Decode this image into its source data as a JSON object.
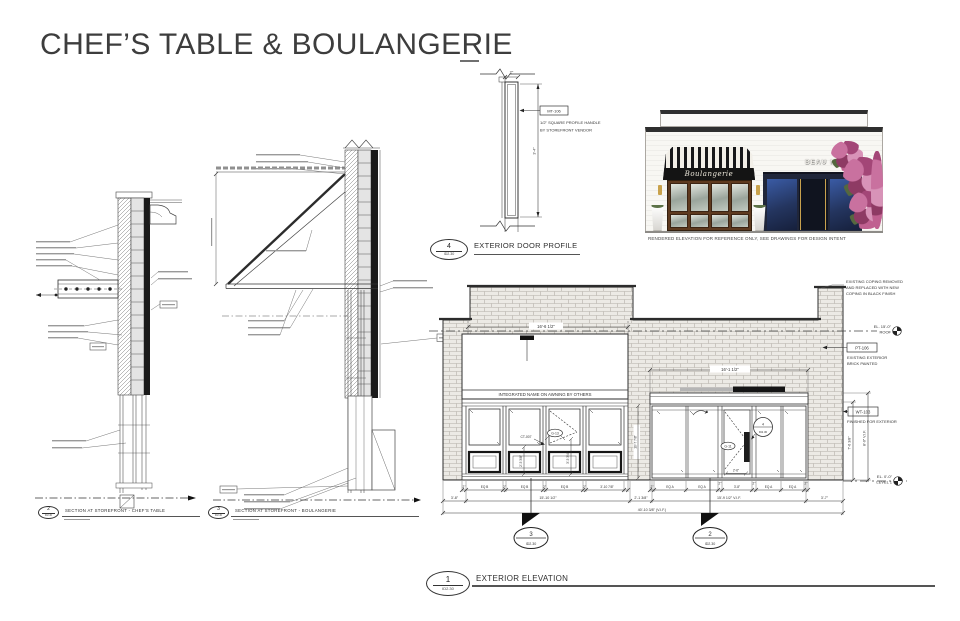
{
  "page": {
    "title": "CHEF’S TABLE & BOULANGERIE"
  },
  "render": {
    "awning_sign": "Boulangerie",
    "storefront_sign": "BEAU MONDE",
    "caption": "RENDERED ELEVATION FOR REFERENCE ONLY, SEE DRAWINGS FOR DESIGN INTENT"
  },
  "door_profile": {
    "bubble_num": "4",
    "bubble_sheet": "ID2.30",
    "title": "EXTERIOR DOOR PROFILE",
    "tag": "MT-106",
    "note1": "1/2\" SQUARE PROFILE HANDLE",
    "note2": "BY STOREFRONT VENDOR",
    "dim_width": "2\"",
    "dim_height": "3'-4\""
  },
  "section_chefs": {
    "bubble_num": "2",
    "bubble_sheet": "ID2.30",
    "title": "SECTION AT STOREFRONT - CHEF'S TABLE"
  },
  "section_boulangerie": {
    "bubble_num": "3",
    "bubble_sheet": "ID2.30",
    "title": "SECTION AT STOREFRONT - BOULANGERIE"
  },
  "elevation": {
    "bubble_num": "1",
    "bubble_sheet": "ID2.30",
    "title": "EXTERIOR ELEVATION",
    "awning_note": "INTEGRATED NAME ON AWNING BY OTHERS",
    "coping_note_1": "EXISTING COPING REMOVED",
    "coping_note_2": "AND REPLACED WITH NEW",
    "coping_note_3": "COPING IN BLACK FINISH",
    "pt_tag": "PT-106",
    "pt_note_1": "EXISTING EXTERIOR",
    "pt_note_2": "BRICK PAINTED",
    "wt_tag": "WT-103",
    "wt_note": "FINISHED FOR EXTERIOR",
    "roof_el": "EL. 15'-0\"",
    "roof_label": "ROOF",
    "level1_el": "EL. 0'-0\"",
    "level1_label": "LEVEL 1",
    "ct_tag": "CT-007",
    "g_tag_left": "G-13",
    "g_tag_right": "G-11",
    "door_detail_num": "4",
    "door_detail_sheet": "ID2.30",
    "cut_left_num": "3",
    "cut_left_sheet": "ID2.30",
    "cut_right_num": "2",
    "cut_right_sheet": "ID2.30",
    "dim_awning": "16'-6 1/2\"",
    "dim_canopy": "16'-1 1/2\"",
    "row_a_left": [
      "2\"",
      "EQ B",
      "2\"",
      "EQ B",
      "2\"",
      "EQ B",
      "2\"",
      "3'-10 7/8\""
    ],
    "row_a_right": [
      "2\"",
      "EQ A",
      "EQ A",
      "2\"",
      "3'-8\"",
      "2\"",
      "EQ A",
      "EQ A",
      "2\""
    ],
    "row_b": [
      "3'-8\"",
      "15'-10 1/2\"",
      "2'-1 3/8\"",
      "15'-9 1/2\" V.I.F.",
      "3'-7\""
    ],
    "dim_total": "40'-10 3/8\" (V.I.F.)",
    "dim_right_inner": "7'-6 3/8\"",
    "dim_right_outer": "8'-0\" V.I.F.",
    "dim_bay_1": "2'-5 3/8\"",
    "dim_bay_2": "3'-5 3/4\"",
    "dim_door": "2'-6\"",
    "dim_pier": "10'-7 7/8\""
  }
}
